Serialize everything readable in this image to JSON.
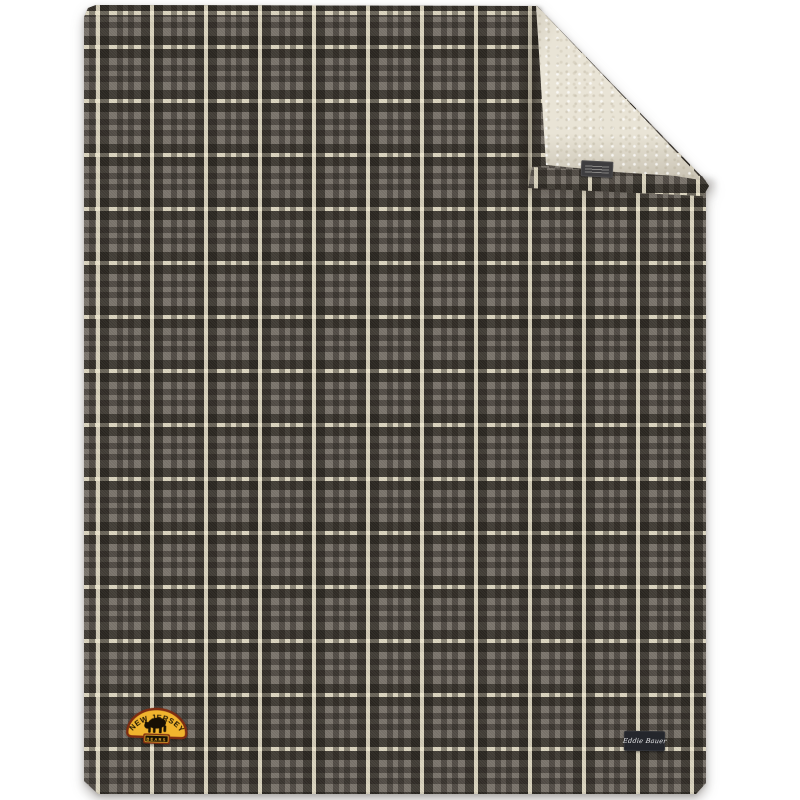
{
  "theme": {
    "page_bg": "#ffffff",
    "plaid_base": "#7a746c",
    "plaid_dark": "#2e2a25",
    "plaid_cream": "#e6dfc4",
    "sherpa": "#e9e4d6",
    "patch_gold": "#f0b42e",
    "patch_rust": "#7e2d12",
    "patch_black": "#171004",
    "label_bg": "#24262c",
    "label_text_color": "#e8e8ea",
    "tag_bg": "#3e3d3f"
  },
  "product": {
    "patch": {
      "arc_text": "NEW JERSEY",
      "banner_text": "BEARS"
    },
    "brand_label": {
      "text": "Eddie Bauer"
    }
  }
}
